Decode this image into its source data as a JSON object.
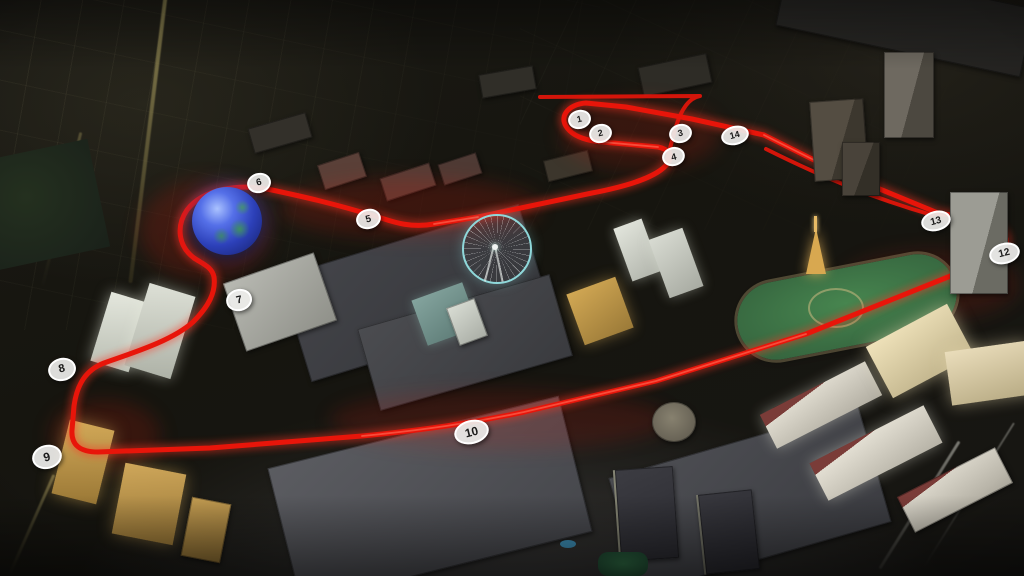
{
  "scene": {
    "description": "Aerial night render of the Las Vegas Strip with a Formula 1 street-circuit route overlaid in glowing red",
    "city": "Las Vegas",
    "track_color": "#e8150a",
    "track_glow_color": "#ff3522",
    "track_core_color": "#ff6a55",
    "marker_style": {
      "fill": "rgba(238,238,235,0.92)",
      "text_color": "#1a1a1a",
      "ring_color": "#ffffff"
    }
  },
  "markers": [
    {
      "label": "1",
      "x": 577,
      "y": 117
    },
    {
      "label": "2",
      "x": 598,
      "y": 131
    },
    {
      "label": "3",
      "x": 678,
      "y": 131
    },
    {
      "label": "4",
      "x": 672,
      "y": 155
    },
    {
      "label": "5",
      "x": 366,
      "y": 217
    },
    {
      "label": "6",
      "x": 257,
      "y": 181
    },
    {
      "label": "7",
      "x": 237,
      "y": 298
    },
    {
      "label": "8",
      "x": 60,
      "y": 367
    },
    {
      "label": "9",
      "x": 45,
      "y": 455
    },
    {
      "label": "10",
      "x": 469,
      "y": 430
    },
    {
      "label": "12",
      "x": 1002,
      "y": 251
    },
    {
      "label": "13",
      "x": 934,
      "y": 219
    },
    {
      "label": "14",
      "x": 733,
      "y": 133
    }
  ],
  "landmarks": [
    "msg-sphere",
    "high-roller-wheel",
    "venetian-palazzo",
    "sands-expo-roof",
    "treasure-island",
    "mirage",
    "flamingo",
    "caesars-palace",
    "colosseum",
    "bellagio",
    "bellagio-garden",
    "eiffel-tower-paris",
    "strip-boulevard",
    "koval-lane",
    "airport-runway"
  ]
}
